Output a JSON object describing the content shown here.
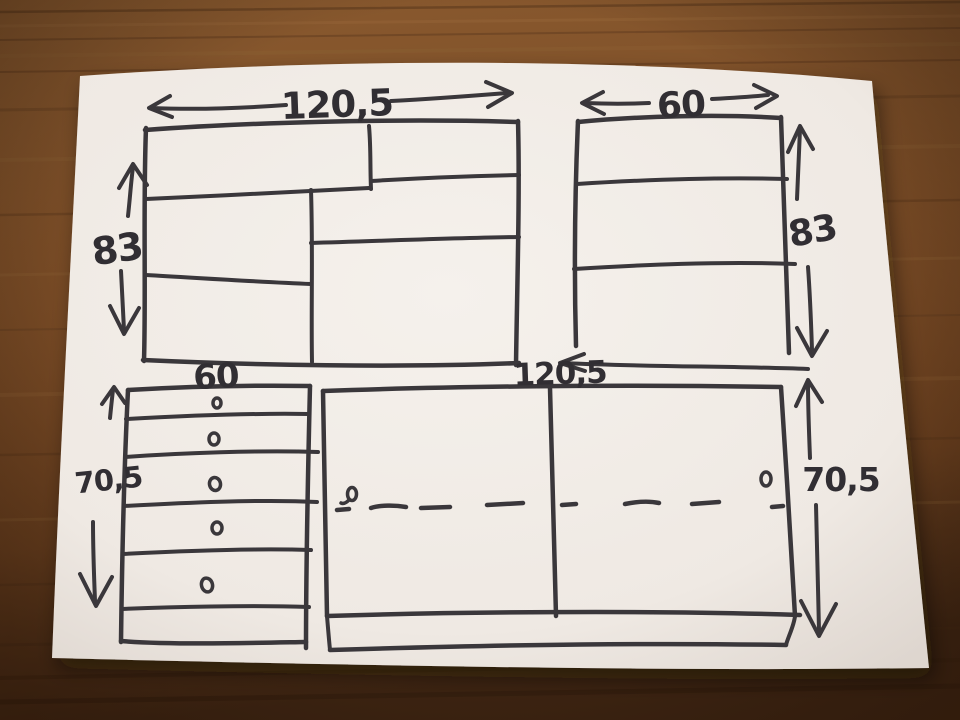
{
  "scene": {
    "description": "Photograph of a hand-drawn furniture sketch in black marker on a white sheet of paper lying on a wooden table",
    "surface": "wooden table",
    "medium": "black marker on white paper"
  },
  "colors": {
    "ink": "#3a373b",
    "paper": "#f3eee9",
    "paper_shadow": "#ded6cf",
    "wood": "#7d4e27",
    "wood_dark": "#4a2b16",
    "wood_light": "#96663a"
  },
  "sketch": {
    "top_left_cabinet": {
      "name": "wide cabinet with staggered shelves",
      "width_label": "120,5",
      "height_label": "83",
      "compartments": 6
    },
    "top_right_cabinet": {
      "name": "narrow cabinet with two shelves",
      "width_label": "60",
      "height_label": "83",
      "shelves": 2
    },
    "bottom_left_dresser": {
      "name": "drawer unit",
      "width_label": "60",
      "height_label": "70,5",
      "drawers": 6,
      "knobs": 5
    },
    "bottom_right_unit": {
      "name": "wide two-door cabinet with plinth",
      "width_label": "120,5",
      "height_label": "70,5",
      "doors": 2,
      "handles": 2,
      "dashed_centerline": true
    }
  }
}
